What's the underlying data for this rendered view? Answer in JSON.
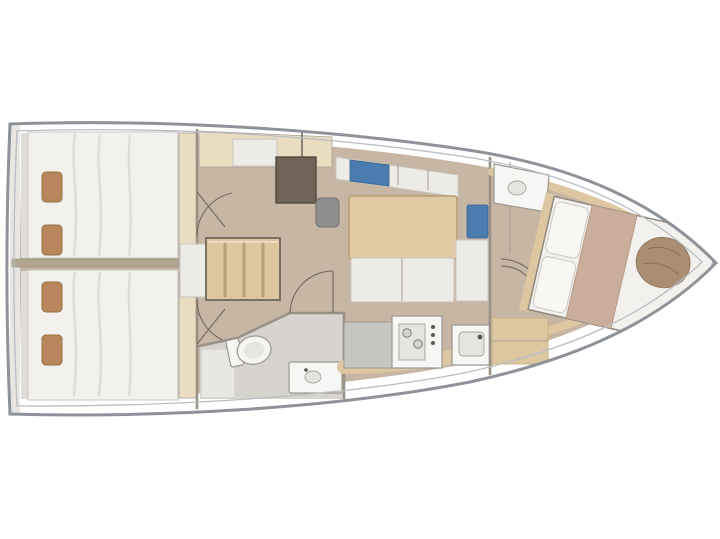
{
  "canvas": {
    "width": 720,
    "height": 539,
    "background": "#ffffff"
  },
  "palette": {
    "hull_outline": "#8d9398",
    "hull_inner": "#b9bec3",
    "deck_white": "#ffffff",
    "floor": "#c8b6a5",
    "floor_head": "#d7d4cf",
    "wall": "#9a9186",
    "line": "#a9a29a",
    "door_arc": "#6f685e",
    "wood": "#dcc7a1",
    "wood_light": "#e9dcc1",
    "wood_dark": "#c9b183",
    "mattress": "#f2f1ee",
    "mattress_edge": "#cac7c0",
    "bench_white": "#edebe6",
    "shade": "#dbd8d2",
    "pillow_brown": "#b8865b",
    "pillow_edge": "#97703f",
    "desk_brown": "#6f6355",
    "seat_gray": "#8f8f8f",
    "cushion_blue": "#4a7cb0",
    "table": "#dfcaa4",
    "table_edge": "#b59e71",
    "fixture_white": "#f6f6f4",
    "fixture_edge": "#9a978f",
    "counter_gray": "#c7c5c0",
    "blanket_tan": "#c9ae9b",
    "throw_brown": "#a98e72"
  }
}
